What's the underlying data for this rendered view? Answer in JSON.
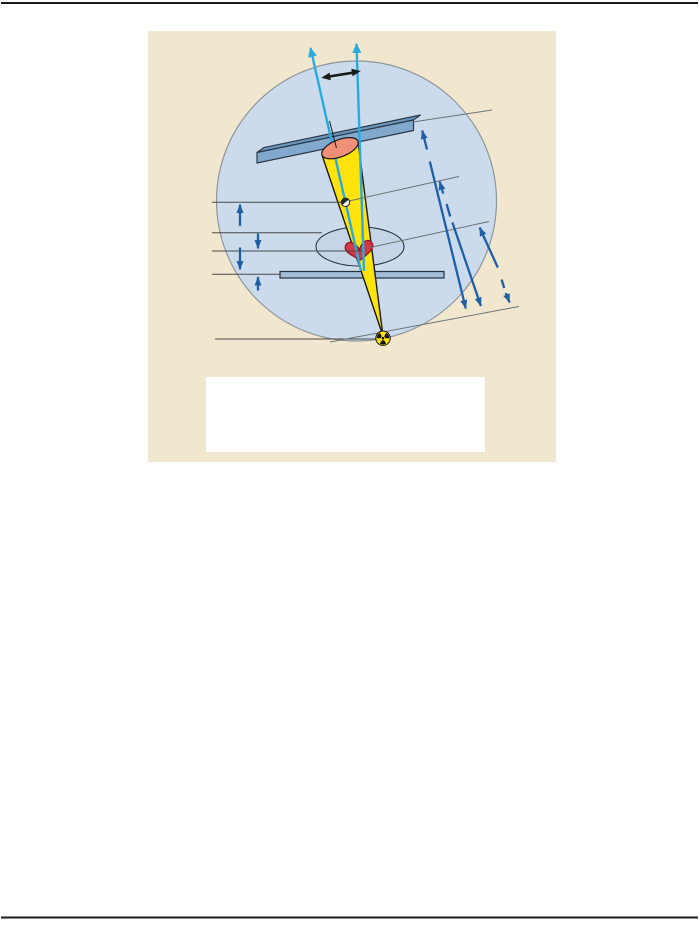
{
  "page": {
    "background": "#ffffff",
    "rule_color": "#1a1a1a"
  },
  "figure": {
    "panel_bg": "#f1e7ce",
    "caption_box": {
      "bg": "#ffffff",
      "text": ""
    },
    "icons": [
      "radiation-trefoil-icon",
      "oscillation-double-arrow-icon",
      "fulcrum-point-icon",
      "beam-direction-arrow-icon"
    ],
    "colors": {
      "circle_fill": "#cbdbec",
      "circle_stroke": "#8e959c",
      "body_ellipse_fill": "#c4d5e7",
      "body_ellipse_stroke": "#1f2937",
      "detector_front": "#82a8cd",
      "detector_top": "#6b96be",
      "detector_outline": "#2b3947",
      "table_fill": "#a3bdd7",
      "table_outline": "#23313f",
      "cone_yellow": "#ffe30a",
      "cone_outline": "#1a1a1a",
      "cone_cut_face": "#f19078",
      "heart_fill": "#d63841",
      "heart_outline": "#8f1420",
      "beam_cyan": "#2baae0",
      "dim_arrow_blue": "#1e5fa6",
      "leader_dark": "#4a4a4a",
      "distance_gray": "#6e7479",
      "black": "#1a1a1a",
      "source_disc": "#ffe30a",
      "source_symbol": "#111111",
      "fulcrum_fill": "#ffffff",
      "fulcrum_dark": "#1c2b36",
      "fulcrum_stroke": "#222222"
    }
  }
}
